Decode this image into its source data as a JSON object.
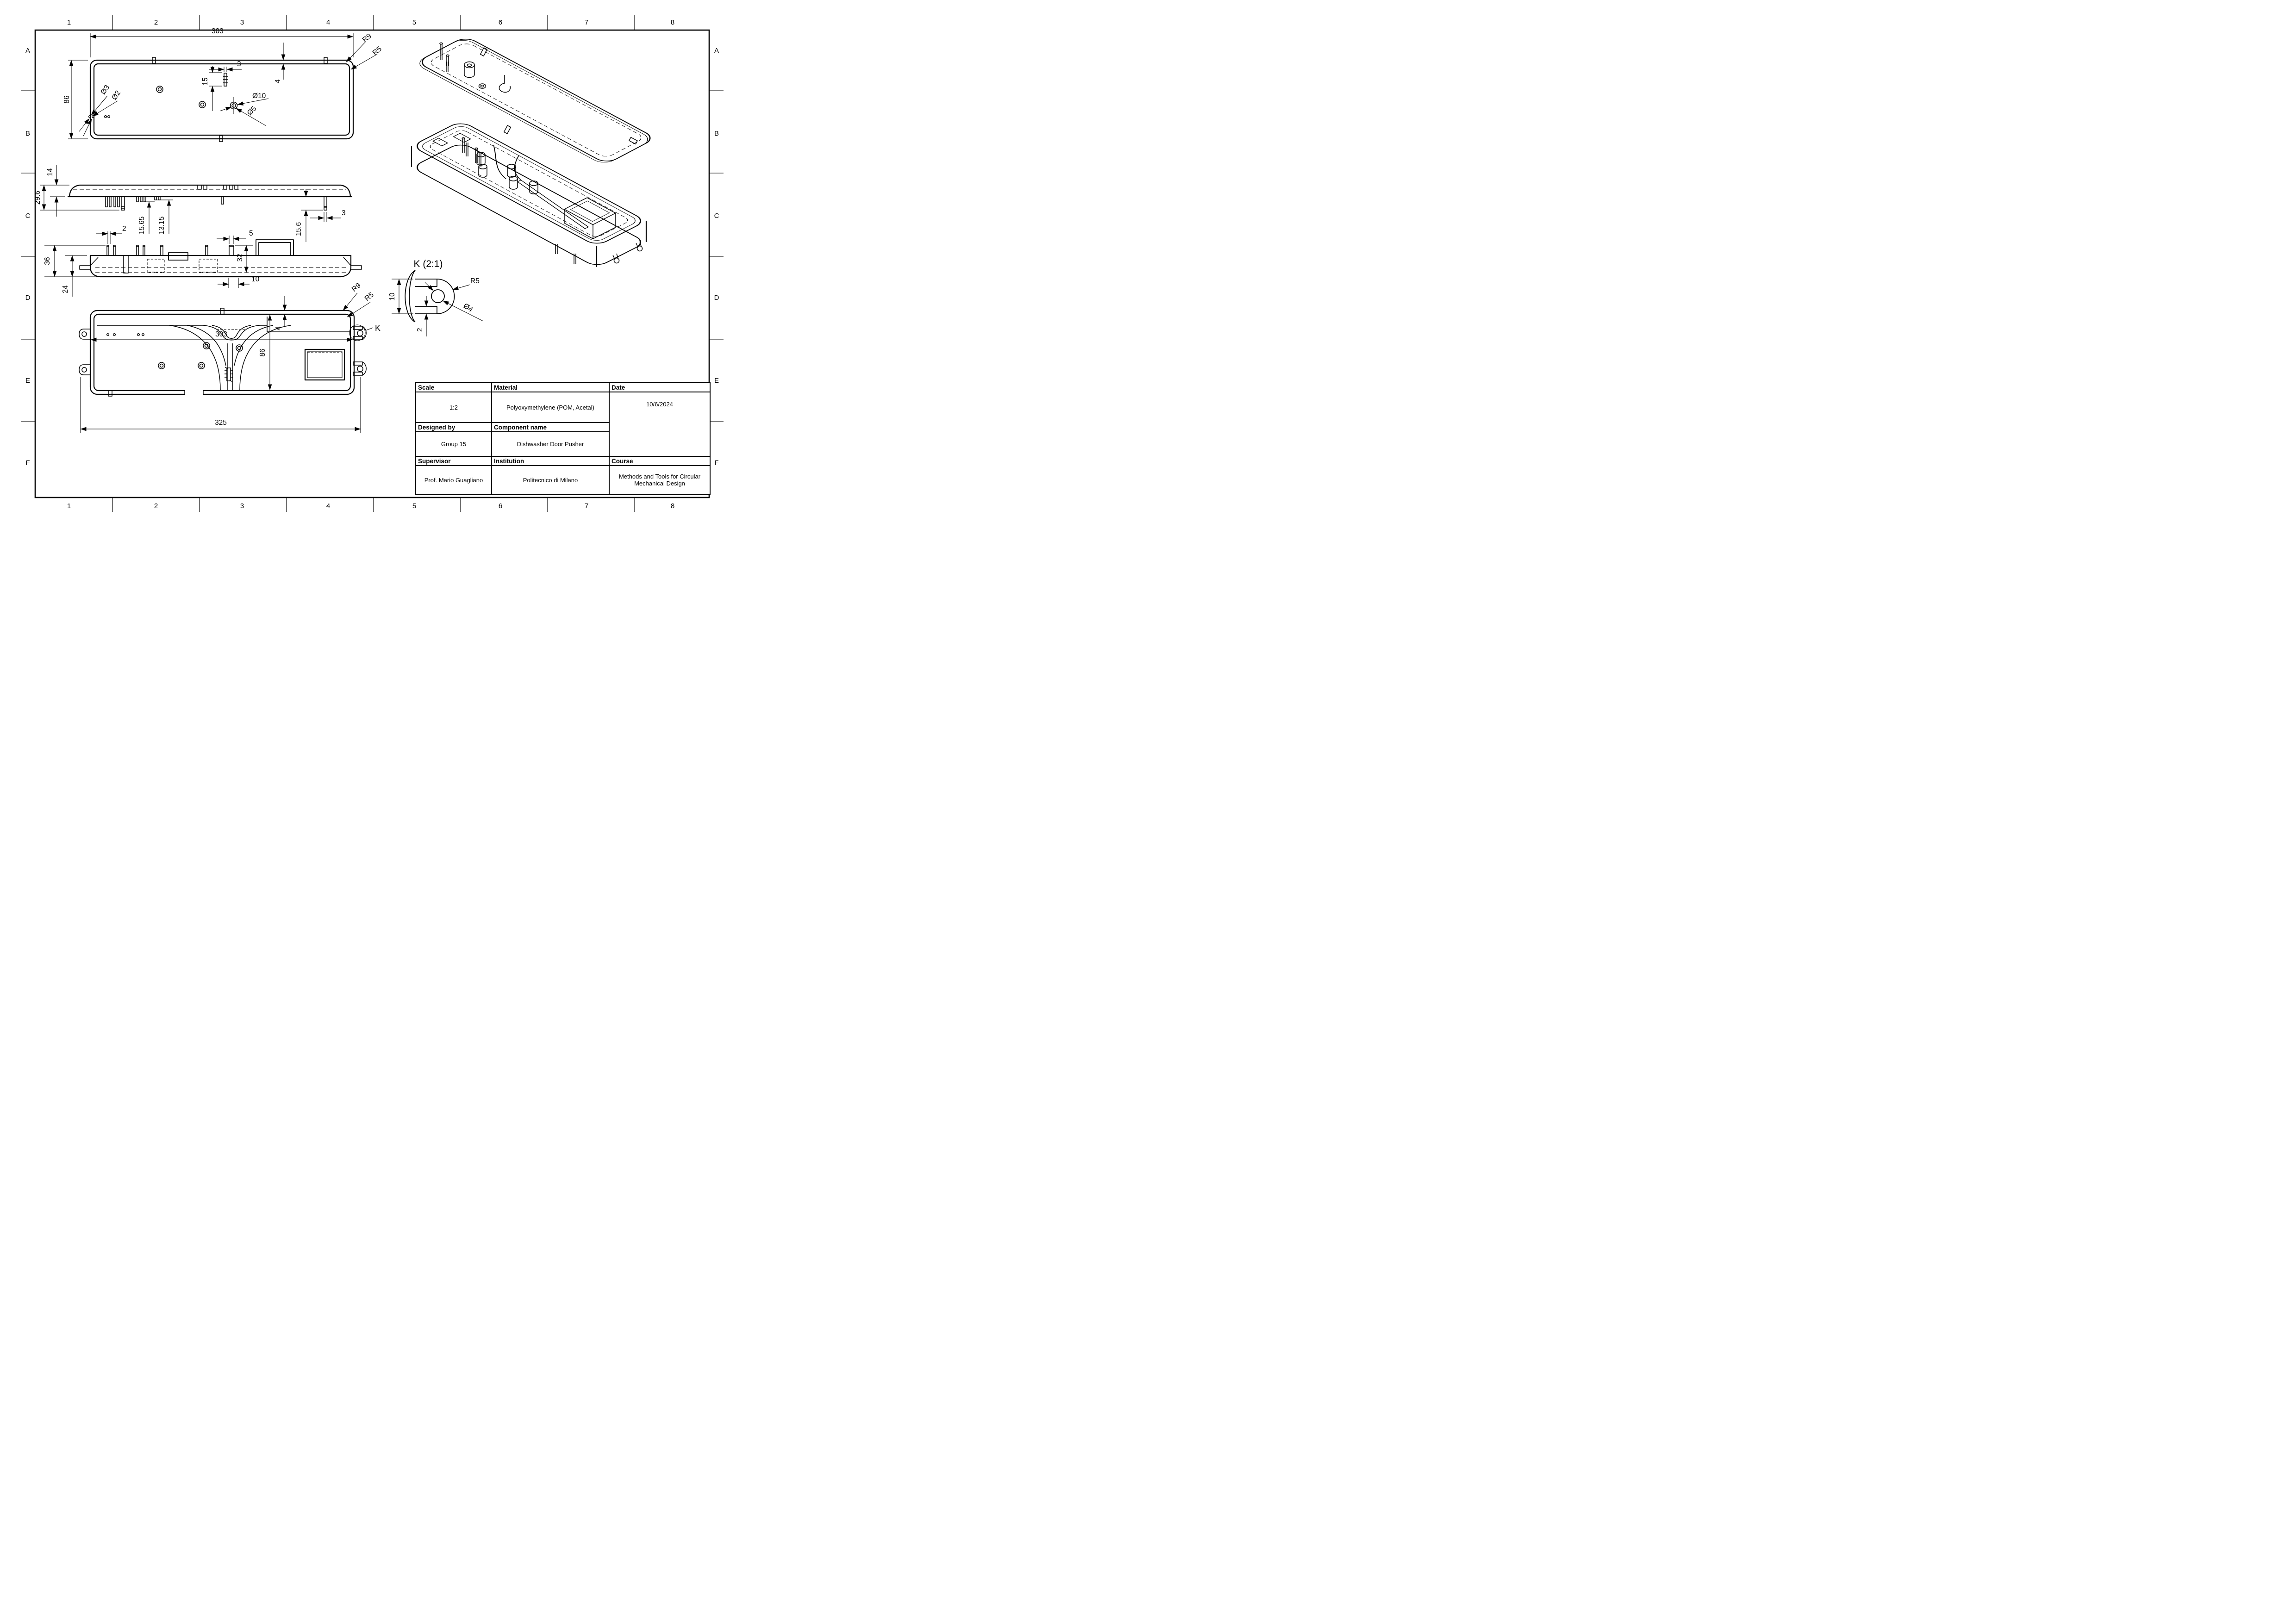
{
  "sheet": {
    "cols": [
      "1",
      "2",
      "3",
      "4",
      "5",
      "6",
      "7",
      "8"
    ],
    "rows": [
      "A",
      "B",
      "C",
      "D",
      "E",
      "F"
    ]
  },
  "views": {
    "top": {
      "w": "303",
      "h": "86",
      "pin_w": "3",
      "pin_len": "15",
      "wall": "4",
      "d_outer": "Ø10",
      "d_inner": "Ø5",
      "d_hole_a": "Ø3",
      "d_hole_b": "Ø2",
      "r_outer": "R9",
      "r_inner": "R5"
    },
    "side_upper": {
      "body": "14",
      "total": "29.6",
      "pin_a": "15.65",
      "pin_b": "13.15",
      "pin_w": "3",
      "pin_len": "15.6"
    },
    "side_lower": {
      "pin_w": "2",
      "boss_w": "5",
      "inner_h": "32",
      "total_h": "36",
      "depth": "24",
      "slot_w": "10"
    },
    "front": {
      "w": "303",
      "h": "86",
      "wall": "4",
      "r_outer": "R9",
      "r_inner": "R5",
      "detail_mark": "K",
      "overall": "325"
    },
    "detail_k": {
      "title": "K (2:1)",
      "height": "10",
      "bar": "2",
      "radius": "R5",
      "dia": "Ø4"
    }
  },
  "title_block": {
    "scale_label": "Scale",
    "scale_value": "1:2",
    "material_label": "Material",
    "material_value": "Polyoxymethylene (POM, Acetal)",
    "date_label": "Date",
    "date_value": "10/6/2024",
    "designed_label": "Designed by",
    "designed_value": "Group 15",
    "component_label": "Component name",
    "component_value": "Dishwasher Door Pusher",
    "supervisor_label": "Supervisor",
    "supervisor_value": "Prof. Mario Guagliano",
    "institution_label": "Institution",
    "institution_value": "Politecnico di Milano",
    "course_label": "Course",
    "course_value_line1": "Methods and Tools for Circular",
    "course_value_line2": "Mechanical Design"
  }
}
